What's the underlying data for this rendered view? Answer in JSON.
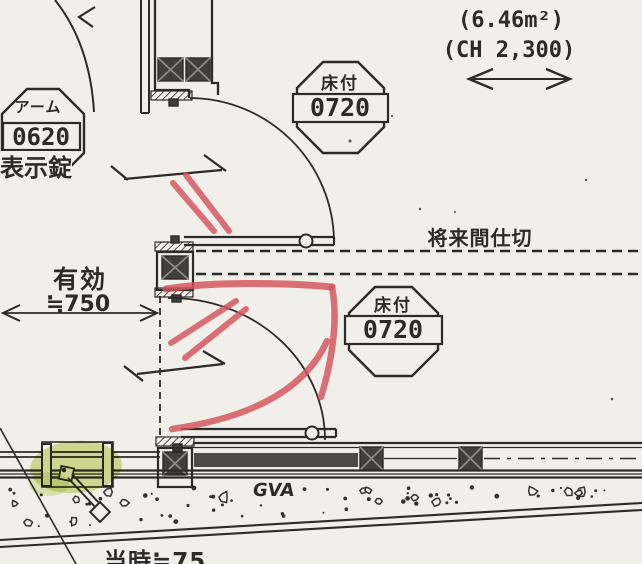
{
  "drawing": {
    "labels": {
      "area": "(6.46m²)",
      "ceiling_height": "(CH 2,300)",
      "future_partition": "将来間仕切",
      "effective_width_title": "有効",
      "effective_width_value": "≒750",
      "track": "GVA",
      "bottom_partial": "当時≒75"
    },
    "tags": {
      "arm": {
        "name": "アーム",
        "size": "0620",
        "lock": "表示錠"
      },
      "floor_top": {
        "name": "床付",
        "size": "0720"
      },
      "floor_bottom": {
        "name": "床付",
        "size": "0720"
      }
    },
    "colors": {
      "paper": "#f1efea",
      "ink": "#2c2b28",
      "red_marker": "#d4525b",
      "green_highlight": "#b7d04a"
    }
  }
}
